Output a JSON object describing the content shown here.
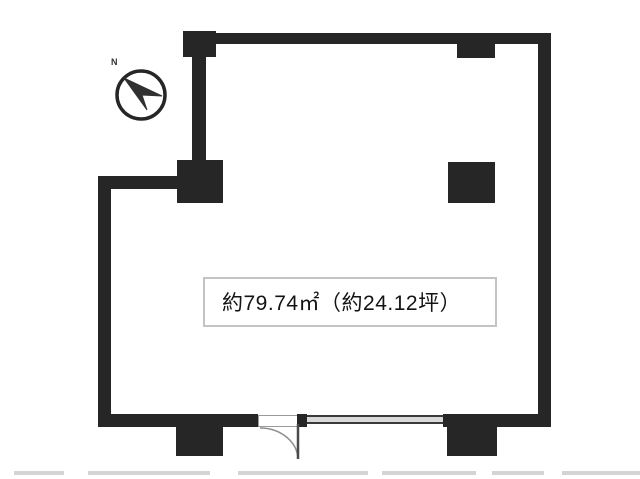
{
  "floorplan": {
    "area_label": "約79.74㎡（約24.12坪）",
    "compass_north_label": "N",
    "colors": {
      "bg": "#ffffff",
      "wall": "#262626",
      "doorline": "#4a4a4a",
      "arcline": "#8f8f8f",
      "windowfill": "#d9d9d9",
      "windowedge": "#3a3a3a",
      "labelborder": "#c4c4c4",
      "labeltext": "#141414",
      "artifact": "#cccccc"
    }
  }
}
